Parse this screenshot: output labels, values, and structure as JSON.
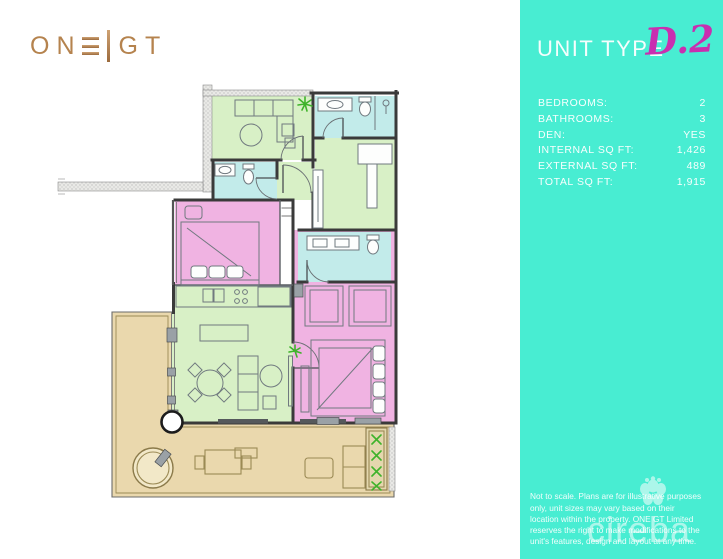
{
  "brand": {
    "name": "ONE GT",
    "part1": "ON",
    "part2": "GT"
  },
  "panel": {
    "title": "UNIT TYPE",
    "unit_code": "D.2",
    "specs": [
      {
        "label": "BEDROOMS:",
        "value": "2"
      },
      {
        "label": "BATHROOMS:",
        "value": "3"
      },
      {
        "label": "DEN:",
        "value": "YES"
      },
      {
        "label": "INTERNAL SQ FT:",
        "value": "1,426"
      },
      {
        "label": "EXTERNAL SQ FT:",
        "value": "489"
      },
      {
        "label": "TOTAL SQ FT:",
        "value": "1,915"
      }
    ],
    "disclaimer": "Not to scale. Plans are for illustrative purposes only, unit sizes may vary based on their location within the property. ONE GT Limited reserves the right to make modifications to the unit's features, design and layout at any time.",
    "watermark_text": "cireba"
  },
  "colors": {
    "sidebar_teal": "#48EDD2",
    "unit_code_magenta": "#C92FB0",
    "logo_bronze": "#B5834E",
    "room_green": "#D8F0C6",
    "room_cyan": "#C2EBEA",
    "room_pink": "#F0B3E2",
    "terrace_tan": "#EAD8AD",
    "terrace_line": "#9B8A55",
    "wall_dark": "#3A3A3A",
    "fixture_gray": "#70797F",
    "plant_green": "#3FB32B"
  }
}
